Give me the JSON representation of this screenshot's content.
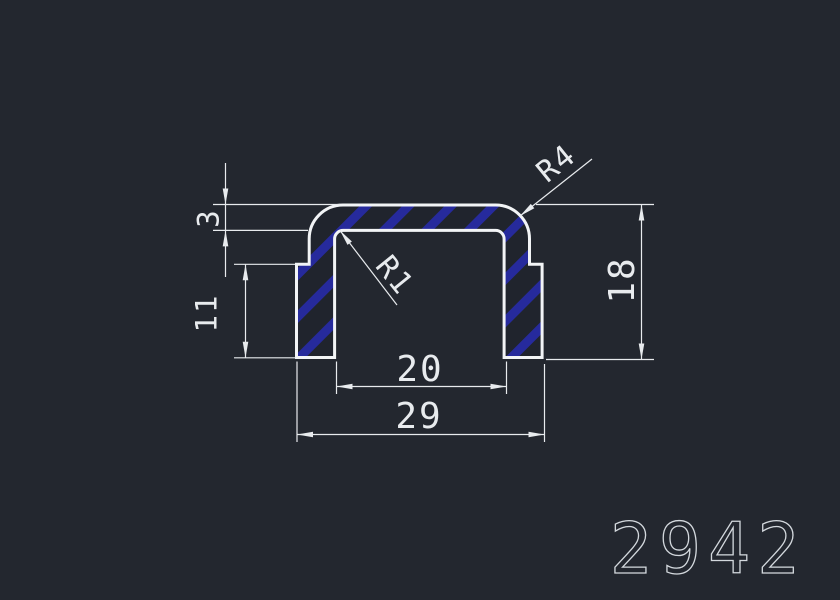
{
  "part_number": "2942",
  "colors": {
    "background": "#23272f",
    "profile_outline": "#f2f4f6",
    "hatch_stripe": "#262a9c",
    "hatch_background": "#20242d",
    "dimension": "#e8ebee",
    "part_number_text": "#d3d8dd"
  },
  "dimensions": {
    "top_wall_thickness": "3",
    "side_leg_height": "11",
    "overall_height": "18",
    "inner_width": "20",
    "overall_width": "29",
    "outer_corner_radius": "R4",
    "inner_corner_radius": "R1"
  }
}
